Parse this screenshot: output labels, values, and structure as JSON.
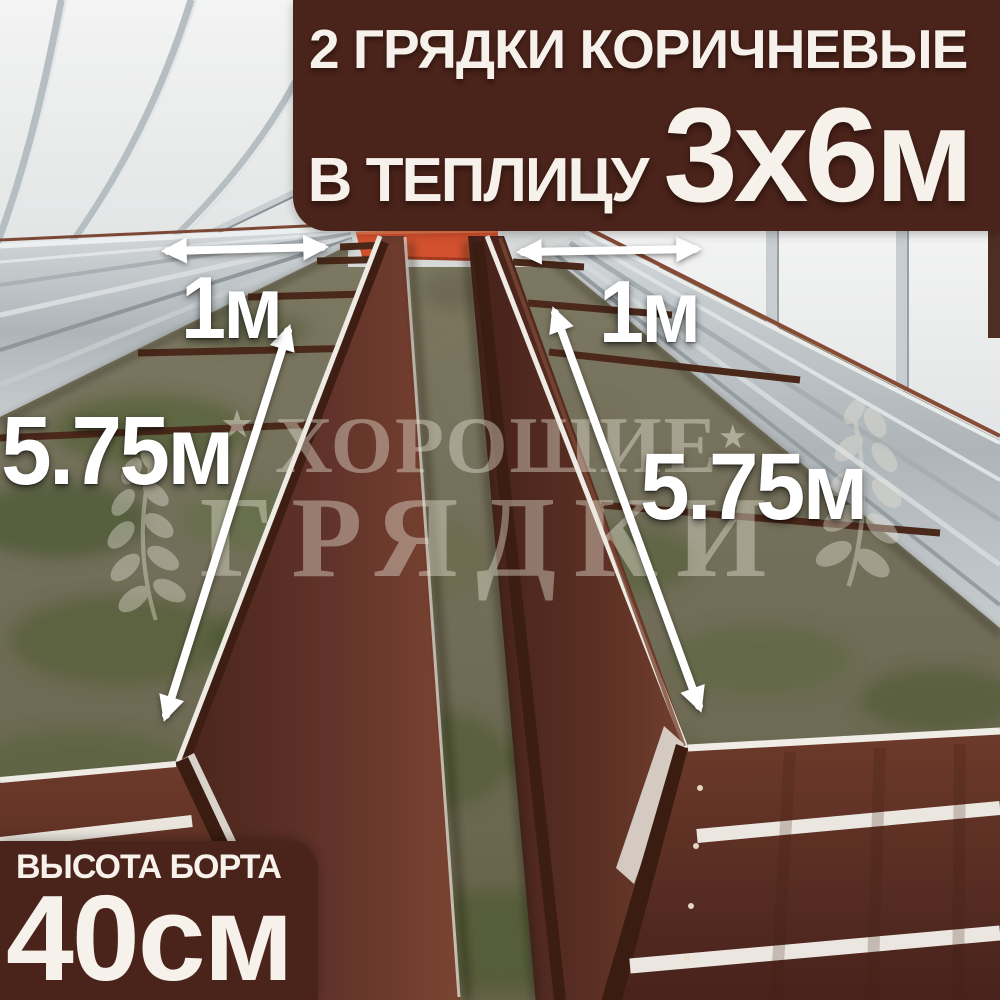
{
  "banner": {
    "line1": "2 ГРЯДКИ КОРИЧНЕВЫЕ",
    "line2_prefix": "В ТЕПЛИЦУ",
    "line2_size": "3х6м"
  },
  "size_badge": {
    "title": "ВЫСОТА БОРТА",
    "value": "40см"
  },
  "dimension_labels": {
    "left_bed_width": "1м",
    "right_bed_width": "1м",
    "left_bed_length": "5.75м",
    "right_bed_length": "5.75м"
  },
  "watermark": {
    "line1": "ХОРОШИЕ",
    "line2": "ГРЯДКИ",
    "star_icon": "★"
  },
  "colors": {
    "overlay_brown": "#4A231A",
    "text_white": "#F6F1EA",
    "arrow_white": "#FFFFFF",
    "bed_brown": "#5E3226",
    "bed_rim_white": "#EFECE6",
    "galvanized_silver": "#B3B9BD",
    "walkway_end_red": "#D3502D",
    "grass_green": "#55603A"
  }
}
